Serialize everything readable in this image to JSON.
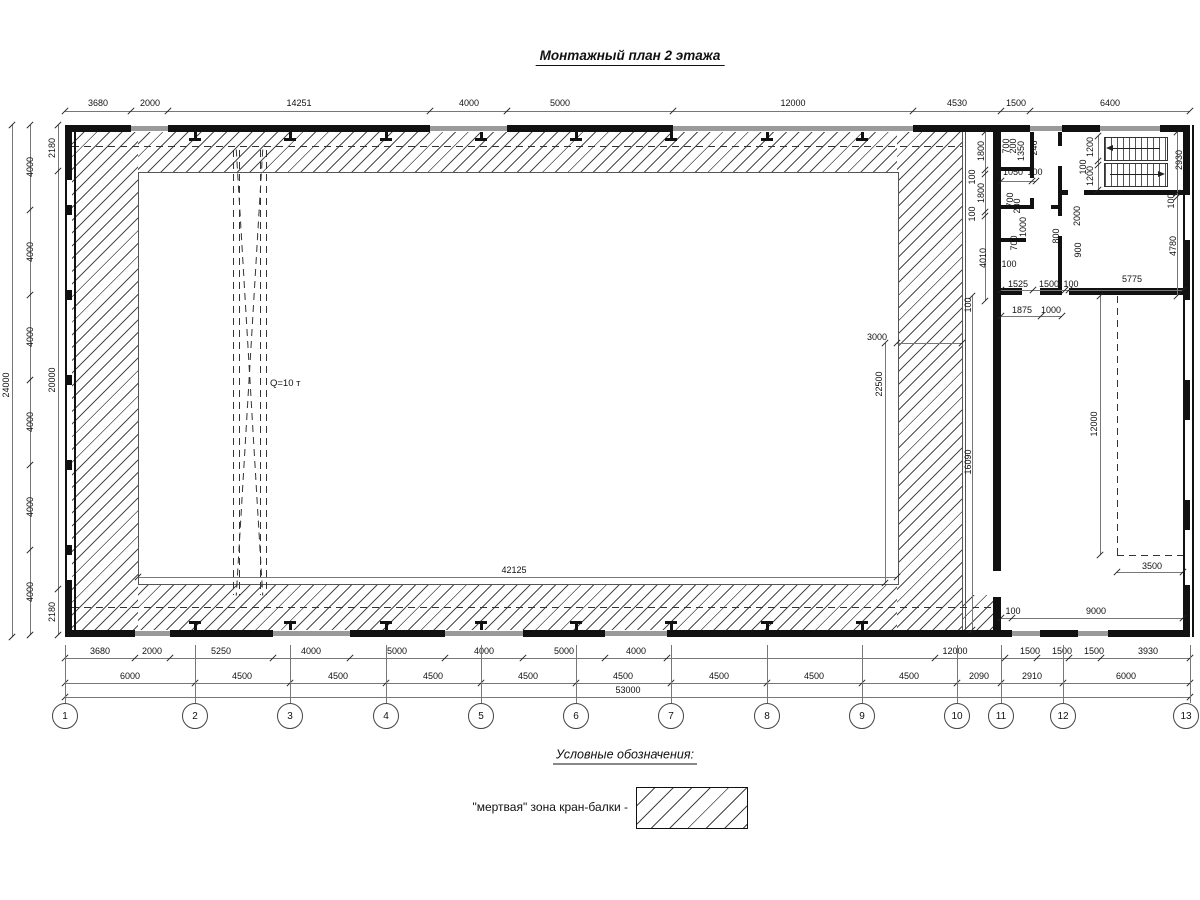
{
  "title": "Монтажный план 2 этажа",
  "crane": {
    "capacity_label": "Q=10 т"
  },
  "legend": {
    "heading": "Условные обозначения:",
    "items": [
      {
        "label": "\"мертвая\" зона кран-балки -",
        "swatch": "hatch"
      }
    ]
  },
  "axes": {
    "numbers": [
      "1",
      "2",
      "3",
      "4",
      "5",
      "6",
      "7",
      "8",
      "9",
      "10",
      "11",
      "12",
      "13"
    ]
  },
  "colors": {
    "line": "#111",
    "window": "#9a9a9a",
    "hatch_stroke": "#4a4a4a",
    "background": "#ffffff"
  },
  "dimensions": [
    {
      "t": "3680",
      "x": 98,
      "y": 103
    },
    {
      "t": "2000",
      "x": 150,
      "y": 103
    },
    {
      "t": "14251",
      "x": 299,
      "y": 103
    },
    {
      "t": "4000",
      "x": 469,
      "y": 103
    },
    {
      "t": "5000",
      "x": 560,
      "y": 103
    },
    {
      "t": "12000",
      "x": 793,
      "y": 103
    },
    {
      "t": "4530",
      "x": 957,
      "y": 103
    },
    {
      "t": "1500",
      "x": 1016,
      "y": 103
    },
    {
      "t": "6400",
      "x": 1110,
      "y": 103
    },
    {
      "t": "24000",
      "x": 6,
      "y": 385,
      "r": -90
    },
    {
      "t": "4000",
      "x": 30,
      "y": 167,
      "r": -90
    },
    {
      "t": "4000",
      "x": 30,
      "y": 252,
      "r": -90
    },
    {
      "t": "4000",
      "x": 30,
      "y": 337,
      "r": -90
    },
    {
      "t": "4000",
      "x": 30,
      "y": 422,
      "r": -90
    },
    {
      "t": "4000",
      "x": 30,
      "y": 507,
      "r": -90
    },
    {
      "t": "4000",
      "x": 30,
      "y": 592,
      "r": -90
    },
    {
      "t": "2180",
      "x": 52,
      "y": 148,
      "r": -90
    },
    {
      "t": "20000",
      "x": 52,
      "y": 380,
      "r": -90
    },
    {
      "t": "2180",
      "x": 52,
      "y": 612,
      "r": -90
    },
    {
      "t": "3680",
      "x": 100,
      "y": 651
    },
    {
      "t": "2000",
      "x": 152,
      "y": 651
    },
    {
      "t": "5250",
      "x": 221,
      "y": 651
    },
    {
      "t": "4000",
      "x": 311,
      "y": 651
    },
    {
      "t": "5000",
      "x": 397,
      "y": 651
    },
    {
      "t": "4000",
      "x": 484,
      "y": 651
    },
    {
      "t": "5000",
      "x": 564,
      "y": 651
    },
    {
      "t": "4000",
      "x": 636,
      "y": 651
    },
    {
      "t": "12000",
      "x": 955,
      "y": 651
    },
    {
      "t": "1500",
      "x": 1030,
      "y": 651
    },
    {
      "t": "1500",
      "x": 1062,
      "y": 651
    },
    {
      "t": "1500",
      "x": 1094,
      "y": 651
    },
    {
      "t": "3930",
      "x": 1148,
      "y": 651
    },
    {
      "t": "6000",
      "x": 130,
      "y": 676
    },
    {
      "t": "4500",
      "x": 242,
      "y": 676
    },
    {
      "t": "4500",
      "x": 338,
      "y": 676
    },
    {
      "t": "4500",
      "x": 433,
      "y": 676
    },
    {
      "t": "4500",
      "x": 528,
      "y": 676
    },
    {
      "t": "4500",
      "x": 623,
      "y": 676
    },
    {
      "t": "4500",
      "x": 719,
      "y": 676
    },
    {
      "t": "4500",
      "x": 814,
      "y": 676
    },
    {
      "t": "4500",
      "x": 909,
      "y": 676
    },
    {
      "t": "2090",
      "x": 979,
      "y": 676
    },
    {
      "t": "2910",
      "x": 1032,
      "y": 676
    },
    {
      "t": "6000",
      "x": 1126,
      "y": 676
    },
    {
      "t": "53000",
      "x": 628,
      "y": 690
    },
    {
      "t": "1800",
      "x": 981,
      "y": 151,
      "r": -90
    },
    {
      "t": "100",
      "x": 972,
      "y": 177,
      "r": -90
    },
    {
      "t": "1800",
      "x": 981,
      "y": 193,
      "r": -90
    },
    {
      "t": "100",
      "x": 972,
      "y": 214,
      "r": -90
    },
    {
      "t": "4010",
      "x": 983,
      "y": 258,
      "r": -90
    },
    {
      "t": "100",
      "x": 968,
      "y": 305,
      "r": -90
    },
    {
      "t": "16090",
      "x": 968,
      "y": 462,
      "r": -90
    },
    {
      "t": "700",
      "x": 1006,
      "y": 146,
      "r": -90
    },
    {
      "t": "200",
      "x": 1013,
      "y": 146,
      "r": -90
    },
    {
      "t": "1350",
      "x": 1021,
      "y": 151,
      "r": -90
    },
    {
      "t": "246",
      "x": 1034,
      "y": 148,
      "r": -90
    },
    {
      "t": "1050",
      "x": 1013,
      "y": 172
    },
    {
      "t": "100",
      "x": 1035,
      "y": 172
    },
    {
      "t": "700",
      "x": 1010,
      "y": 200,
      "r": -90
    },
    {
      "t": "200",
      "x": 1017,
      "y": 206,
      "r": -90
    },
    {
      "t": "1000",
      "x": 1023,
      "y": 227,
      "r": -90
    },
    {
      "t": "700",
      "x": 1014,
      "y": 243,
      "r": -90
    },
    {
      "t": "2000",
      "x": 1077,
      "y": 216,
      "r": -90
    },
    {
      "t": "800",
      "x": 1056,
      "y": 236,
      "r": -90
    },
    {
      "t": "900",
      "x": 1078,
      "y": 250,
      "r": -90
    },
    {
      "t": "1200",
      "x": 1090,
      "y": 147,
      "r": -90
    },
    {
      "t": "100",
      "x": 1083,
      "y": 167,
      "r": -90
    },
    {
      "t": "1200",
      "x": 1090,
      "y": 176,
      "r": -90
    },
    {
      "t": "2930",
      "x": 1179,
      "y": 160,
      "r": -90
    },
    {
      "t": "100",
      "x": 1171,
      "y": 201,
      "r": -90
    },
    {
      "t": "4780",
      "x": 1173,
      "y": 246,
      "r": -90
    },
    {
      "t": "100",
      "x": 1009,
      "y": 264
    },
    {
      "t": "1525",
      "x": 1018,
      "y": 284
    },
    {
      "t": "1500",
      "x": 1049,
      "y": 284
    },
    {
      "t": "100",
      "x": 1071,
      "y": 284
    },
    {
      "t": "5775",
      "x": 1132,
      "y": 279
    },
    {
      "t": "1875",
      "x": 1022,
      "y": 310
    },
    {
      "t": "1000",
      "x": 1051,
      "y": 310
    },
    {
      "t": "12000",
      "x": 1094,
      "y": 424,
      "r": -90
    },
    {
      "t": "3500",
      "x": 1152,
      "y": 566
    },
    {
      "t": "100",
      "x": 1013,
      "y": 611
    },
    {
      "t": "9000",
      "x": 1096,
      "y": 611
    },
    {
      "t": "3000",
      "x": 877,
      "y": 337
    },
    {
      "t": "22500",
      "x": 879,
      "y": 384,
      "r": -90
    },
    {
      "t": "42125",
      "x": 514,
      "y": 570
    }
  ]
}
